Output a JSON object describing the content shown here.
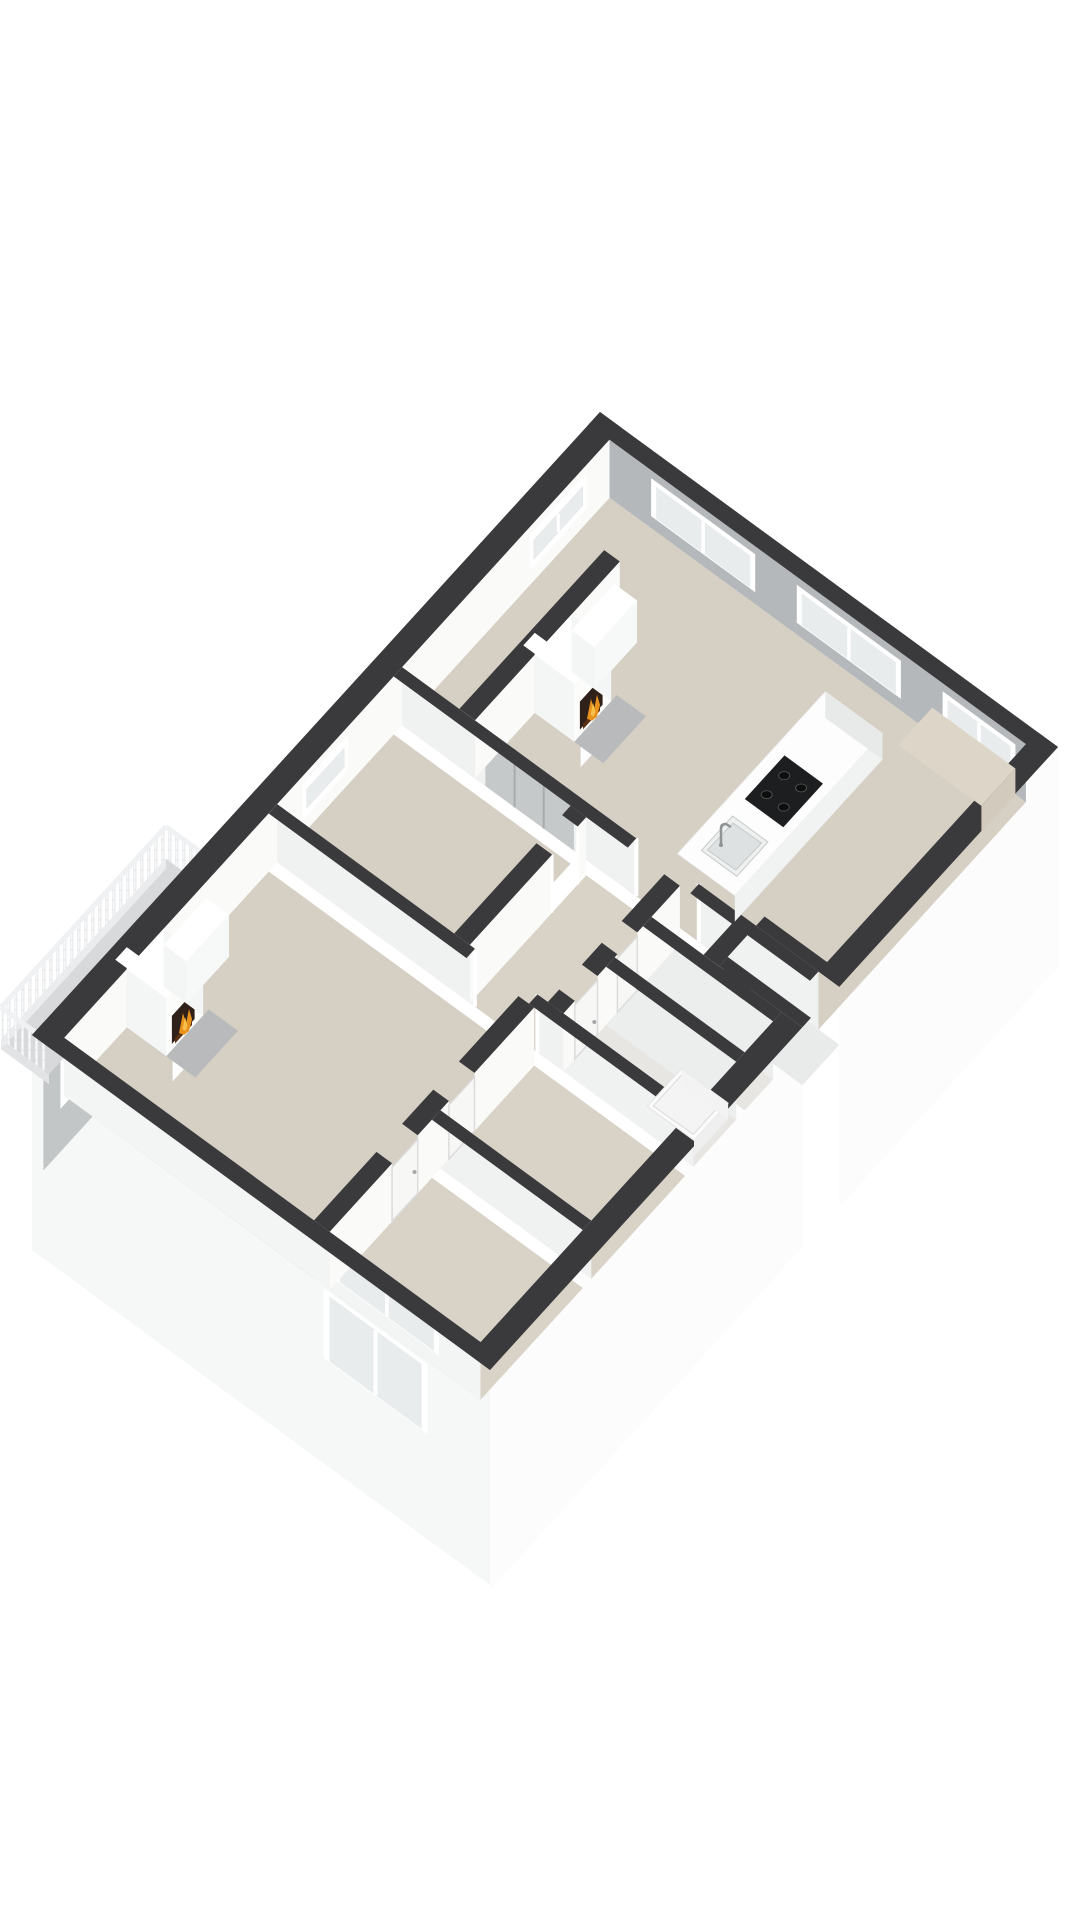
{
  "scene": {
    "type": "3d-floor-plan-render",
    "description": "Axonometric 3D cutaway floor plan of an apartment on a plain white background, viewed from the south-east above. No text or labels are rendered.",
    "background": "#ffffff"
  },
  "palette": {
    "wall_top_dark": "#3a3a3c",
    "ext_wall_gray": "#c3c6c7",
    "int_wall_white": "#fafaf9",
    "int_wall_shaded": "#f0f1f1",
    "int_wall_gray": "#b5b8ba",
    "facade_white": "#fcfcfc",
    "facade_side_white": "#f6f7f7",
    "floor_beige": "#d5cfc4",
    "floor_beige_light": "#d8d2c7",
    "floor_light": "#e7e6e2",
    "floor_shaft": "#c7c9ca",
    "balcony_floor": "#d8d9da",
    "porch_floor": "#e9eaea",
    "counter_white": "#fdfdfd",
    "cooktop_black": "#1d1e1f",
    "sink_gray": "#eef0f0",
    "hearth_gray": "#b9babb",
    "flame_orange": "#e8921e",
    "flame_yellow": "#f8c04a",
    "ember_brown": "#5a3014",
    "firebox_dark": "#30201a",
    "front_door_brown": "#7d4a33",
    "wardrobe_gray": "#c6c9ca",
    "glass": "#e9eced",
    "window_frame": "#ffffff",
    "railing_white": "#f7f8f9"
  },
  "features": {
    "fireplaces": 2,
    "balcony": 1,
    "entry_doors": 1,
    "interior_doors": 4,
    "windows_visible": 10,
    "kitchen": {
      "cooktop_burners": 4,
      "sink": 1
    }
  },
  "rooms": [
    {
      "name": "living-room-kitchen",
      "floor": "beige"
    },
    {
      "name": "living-room-sw",
      "floor": "beige"
    },
    {
      "name": "bedroom-middle",
      "floor": "beige"
    },
    {
      "name": "bedroom-south-1",
      "floor": "beige"
    },
    {
      "name": "bedroom-south-2",
      "floor": "beige"
    },
    {
      "name": "hallway",
      "floor": "beige"
    },
    {
      "name": "bathroom",
      "floor": "light"
    },
    {
      "name": "toilet",
      "floor": "light"
    },
    {
      "name": "shaft",
      "floor": "gray"
    },
    {
      "name": "entry-porch",
      "floor": "light-gray"
    },
    {
      "name": "balcony",
      "floor": "gray"
    }
  ]
}
